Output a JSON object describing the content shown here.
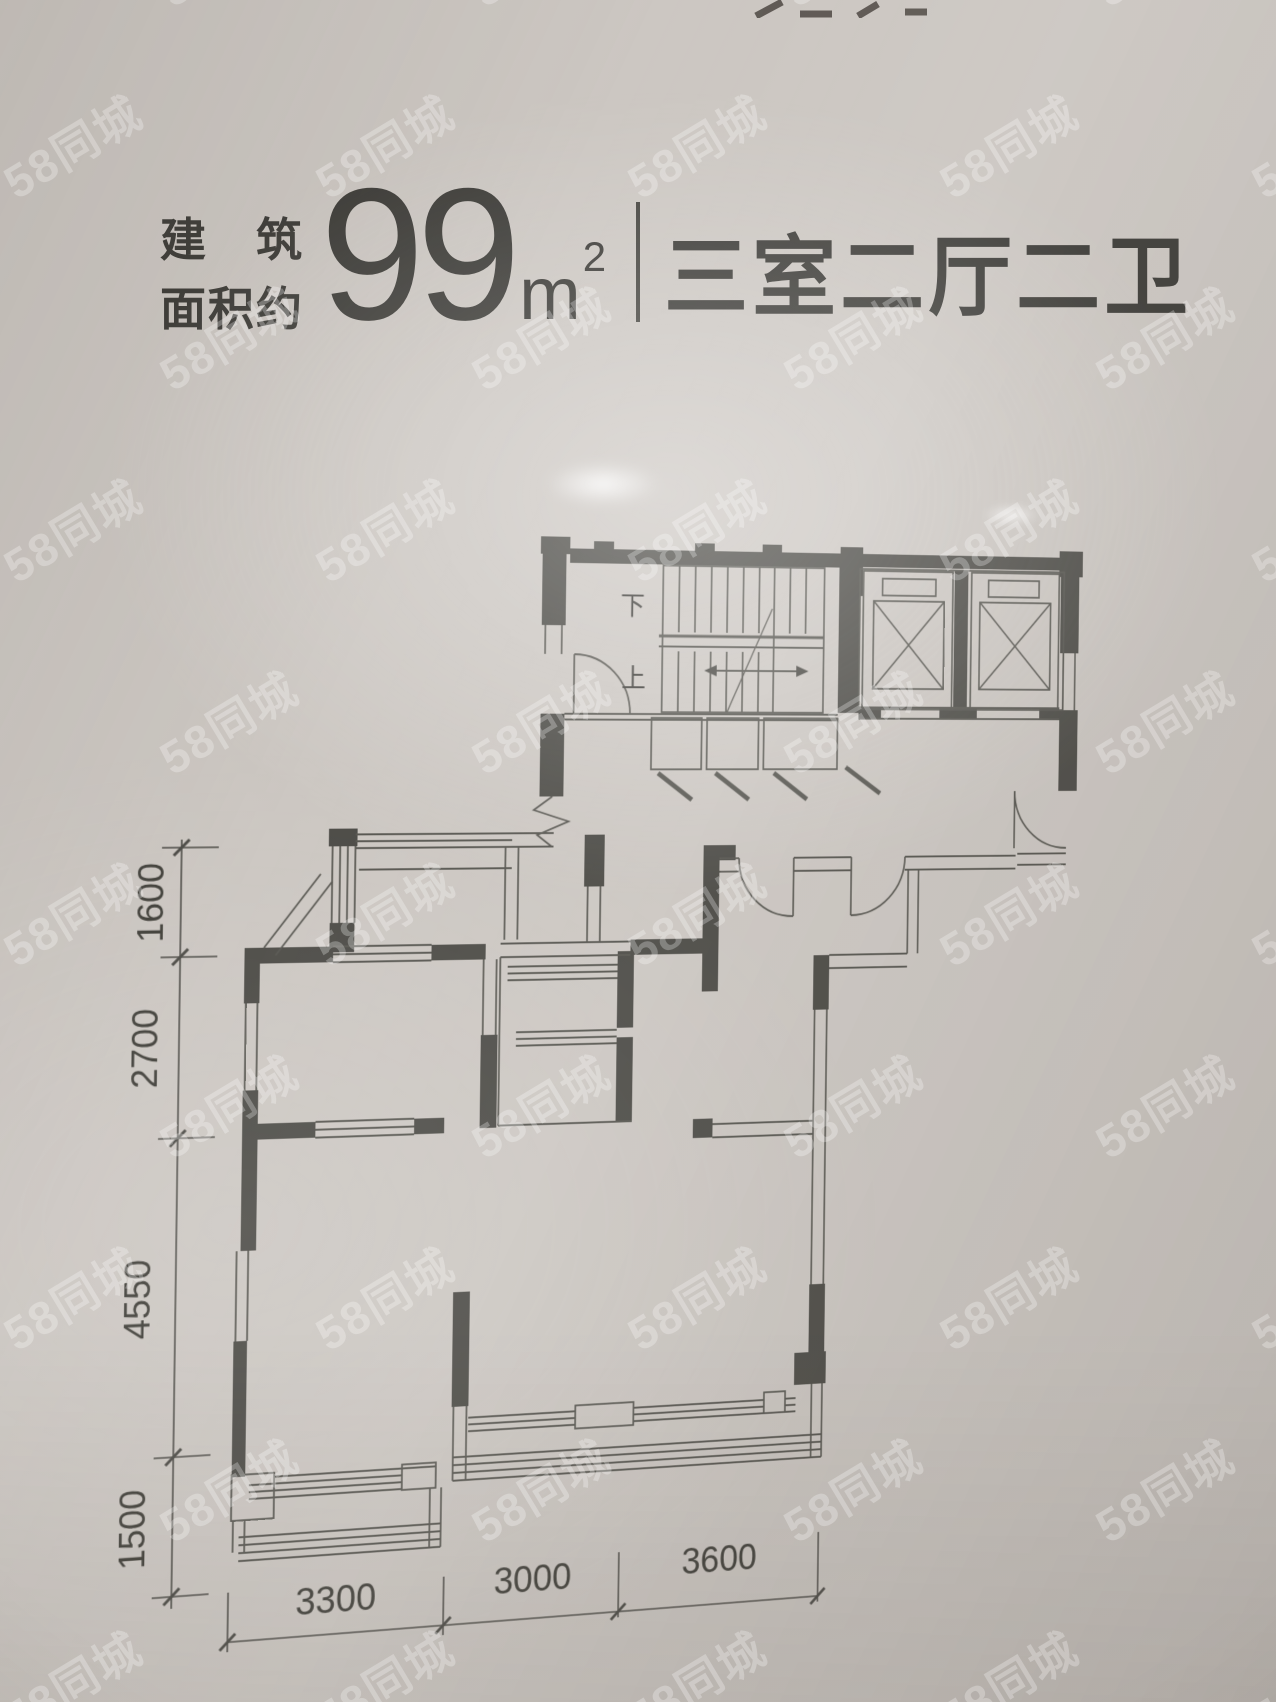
{
  "photo": {
    "background_color": "#ccc7c2",
    "line_color": "#4b4a45",
    "text_color": "#3c3b37"
  },
  "watermark": {
    "text": "58同城",
    "color": "#ffffff",
    "opacity": 0.27,
    "font_size": 46,
    "rotation_deg": -31,
    "tile_x": 312,
    "tile_y": 192,
    "row_offset_x": 156
  },
  "header": {
    "area_label_line1": "建筑",
    "area_label_line2": "面积约",
    "area_value": "99",
    "area_unit_base": "m",
    "area_unit_exp": "2",
    "layout_title": "三室二厅二卫"
  },
  "floor_plan": {
    "stair_down_label": "下",
    "stair_up_label": "上",
    "dims_left": [
      "1600",
      "2700",
      "4550",
      "1500"
    ],
    "dims_bottom": [
      "3300",
      "3000",
      "3600"
    ]
  }
}
